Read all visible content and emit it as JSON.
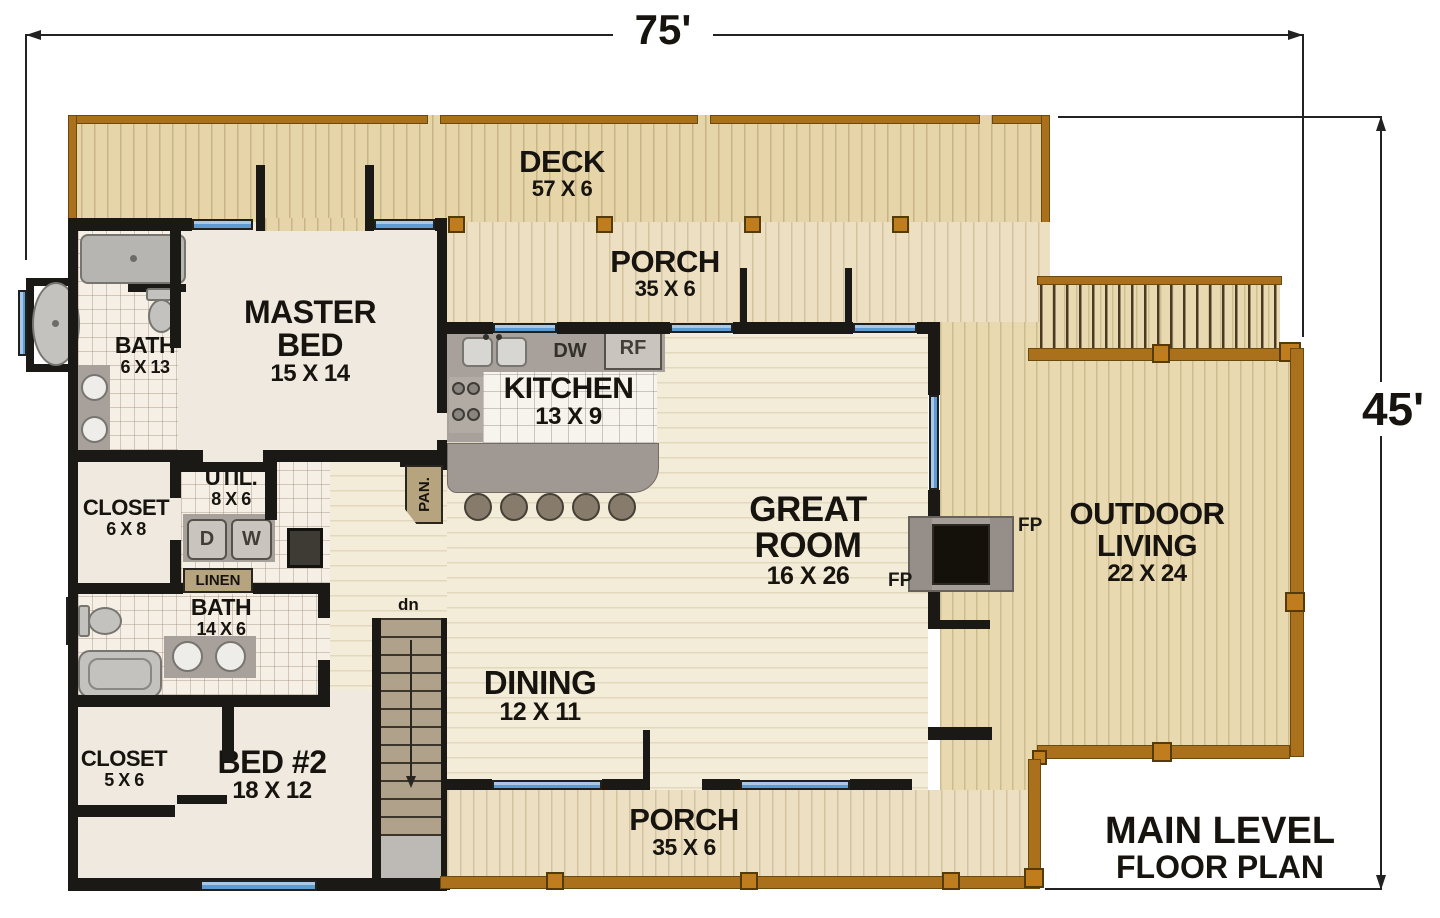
{
  "dimensions": {
    "width": "75'",
    "height": "45'"
  },
  "title": {
    "line1": "MAIN LEVEL",
    "line2": "FLOOR PLAN"
  },
  "rooms": {
    "deck": {
      "name": "DECK",
      "size": "57 X 6"
    },
    "porch_top": {
      "name": "PORCH",
      "size": "35 X 6"
    },
    "master_bed": {
      "name": "MASTER BED",
      "size": "15 X 14"
    },
    "master_bath": {
      "name": "BATH",
      "size": "6 X 13"
    },
    "kitchen": {
      "name": "KITCHEN",
      "size": "13 X 9"
    },
    "closet_master": {
      "name": "CLOSET",
      "size": "6 X 8"
    },
    "utility": {
      "name": "UTIL.",
      "size": "8 X 6"
    },
    "bath2": {
      "name": "BATH",
      "size": "14 X 6"
    },
    "closet_bed2": {
      "name": "CLOSET",
      "size": "5 X 6"
    },
    "bed2": {
      "name": "BED #2",
      "size": "18 X 12"
    },
    "dining": {
      "name": "DINING",
      "size": "12 X 11"
    },
    "great_room": {
      "name": "GREAT ROOM",
      "size": "16 X 26"
    },
    "outdoor_living": {
      "name": "OUTDOOR LIVING",
      "size": "22 X 24"
    },
    "porch_bottom": {
      "name": "PORCH",
      "size": "35 X 6"
    }
  },
  "fixtures": {
    "dishwasher": "DW",
    "refrigerator": "RF",
    "dryer": "D",
    "washer": "W",
    "linen": "LINEN",
    "pantry": "PAN.",
    "stairs_down": "dn",
    "fireplace_label_left": "FP",
    "fireplace_label_right": "FP"
  },
  "colors": {
    "wall": "#1b1915",
    "deck_edge_brown": "#ab701b",
    "window_blue": "#5f9bd3",
    "deck_floor": "#e6d5a9",
    "interior_wood": "#f3ecd8",
    "carpet": "#efe9e0",
    "text": "#17140f"
  }
}
